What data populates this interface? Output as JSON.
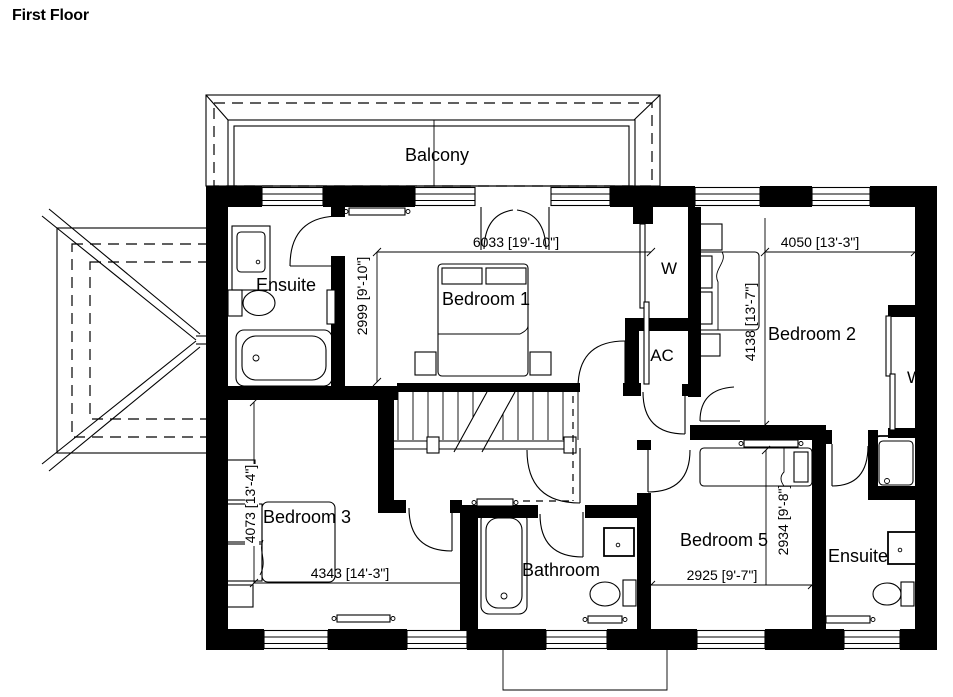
{
  "title": "First Floor",
  "colors": {
    "ink": "#000000",
    "paper": "#ffffff"
  },
  "labels": {
    "balcony": "Balcony",
    "ensuite_top": "Ensuite",
    "bedroom1": "Bedroom 1",
    "wardrobe_center": "W",
    "ac_closet": "AC",
    "bedroom2": "Bedroom 2",
    "wardrobe_right": "W",
    "bedroom3": "Bedroom 3",
    "bathroom": "Bathroom",
    "bedroom5": "Bedroom 5",
    "ensuite_bottom": "Ensuite"
  },
  "dimensions": {
    "bedroom1_width": "6033 [19'-10\"]",
    "bedroom1_depth": "2999 [9'-10\"]",
    "bedroom2_width": "4050 [13'-3\"]",
    "bedroom2_depth": "4138 [13'-7\"]",
    "bedroom3_depth": "4073 [13'-4\"]",
    "bedroom3_width": "4343 [14'-3\"]",
    "bedroom5_width": "2925 [9'-7\"]",
    "bedroom5_depth": "2934 [9'-8\"]"
  }
}
